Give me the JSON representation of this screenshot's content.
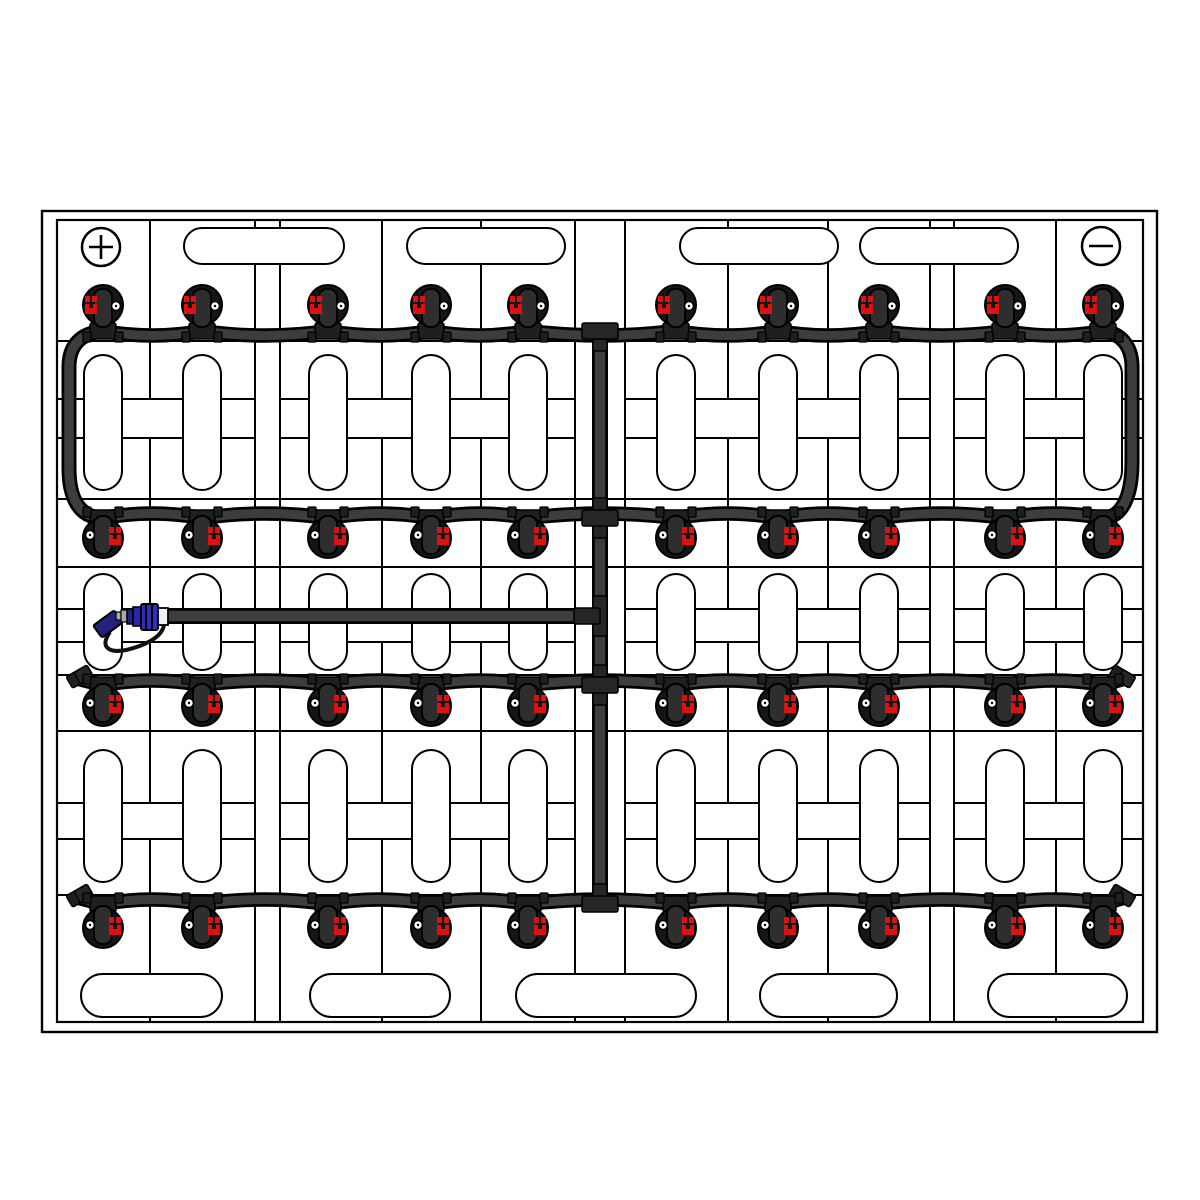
{
  "meta": {
    "title": "Battery watering system layout diagram",
    "canvas": {
      "width": 1200,
      "height": 1200
    }
  },
  "colors": {
    "paper": "#ffffff",
    "line": "#000000",
    "tube": "#3d3d3d",
    "tube_outline": "#000000",
    "fitting": "#262626",
    "valve_dome": "#161616",
    "valve_pill": "#2e2e2e",
    "valve_tab": "#1f1f1f",
    "indicator_red": "#dd1111",
    "indicator_white": "#ffffff",
    "coupling_blue": "#3030c0",
    "coupling_mid_blue": "#2828aa",
    "coupling_navy": "#22227c",
    "coupling_white": "#f0f0f0",
    "coupling_gray": "#aaaaaa"
  },
  "frame": {
    "outer": {
      "x": 42,
      "y": 211,
      "w": 1115,
      "h": 821
    },
    "inner": {
      "x": 57,
      "y": 220,
      "w": 1086,
      "h": 802
    }
  },
  "grid": {
    "line_width": 2,
    "v_single": [
      150,
      382,
      481,
      728,
      828,
      1056
    ],
    "v_pairs": [
      [
        255,
        280
      ],
      [
        575,
        625
      ],
      [
        930,
        954
      ]
    ],
    "h_lines": [
      341,
      499,
      567,
      675,
      731,
      895
    ],
    "corridors": [
      {
        "y1": 399,
        "y2": 438
      },
      {
        "y1": 609,
        "y2": 642
      },
      {
        "y1": 803,
        "y2": 839
      }
    ],
    "corridor_segments": [
      [
        58,
        255
      ],
      [
        280,
        575
      ],
      [
        625,
        930
      ],
      [
        954,
        1142
      ]
    ]
  },
  "cells": {
    "columns": [
      103,
      202,
      328,
      431,
      528,
      676,
      778,
      879,
      1005,
      1103
    ],
    "vent_width": 38,
    "vent_bands": [
      {
        "y": 355,
        "h": 135
      },
      {
        "y": 574,
        "h": 96
      },
      {
        "y": 750,
        "h": 132
      }
    ],
    "top_caps": {
      "y": 228,
      "h": 36,
      "spans": [
        [
          184,
          344
        ],
        [
          407,
          565
        ],
        [
          680,
          838
        ],
        [
          860,
          1018
        ]
      ]
    },
    "bottom_caps": {
      "y": 974,
      "h": 43,
      "spans": [
        [
          81,
          222
        ],
        [
          310,
          450
        ],
        [
          516,
          696
        ],
        [
          760,
          897
        ],
        [
          988,
          1127
        ]
      ]
    }
  },
  "terminals": {
    "positive": {
      "x": 101,
      "y": 247,
      "r": 19,
      "sign": "+"
    },
    "negative": {
      "x": 1101,
      "y": 246,
      "r": 19,
      "sign": "-"
    }
  },
  "watering": {
    "wave_amp": 9,
    "rows": [
      {
        "name": "row-1",
        "tube_y": 331,
        "dome_y": 305,
        "orient": "up",
        "left_end": "loop",
        "right_end": "loop"
      },
      {
        "name": "row-2",
        "tube_y": 518,
        "dome_y": 538,
        "orient": "down",
        "left_end": "loop",
        "right_end": "loop"
      },
      {
        "name": "row-3",
        "tube_y": 685,
        "dome_y": 706,
        "orient": "down",
        "left_end": "plug",
        "right_end": "plug"
      },
      {
        "name": "row-4",
        "tube_y": 904,
        "dome_y": 928,
        "orient": "down",
        "left_end": "plug",
        "right_end": "plug"
      }
    ],
    "manifold": {
      "x": 600,
      "y1": 331,
      "y2": 904
    },
    "supply": {
      "y": 616,
      "x1": 167,
      "x2": 600
    },
    "loops": {
      "left_x": 69,
      "right_x": 1132
    },
    "fittings": [
      {
        "kind": "tee-down",
        "x": 600,
        "y": 331
      },
      {
        "kind": "cross",
        "x": 600,
        "y": 518
      },
      {
        "kind": "tee-left",
        "x": 600,
        "y": 616
      },
      {
        "kind": "cross",
        "x": 600,
        "y": 685
      },
      {
        "kind": "tee-up",
        "x": 600,
        "y": 904
      }
    ],
    "coupling": {
      "x": 95,
      "y": 616
    }
  }
}
